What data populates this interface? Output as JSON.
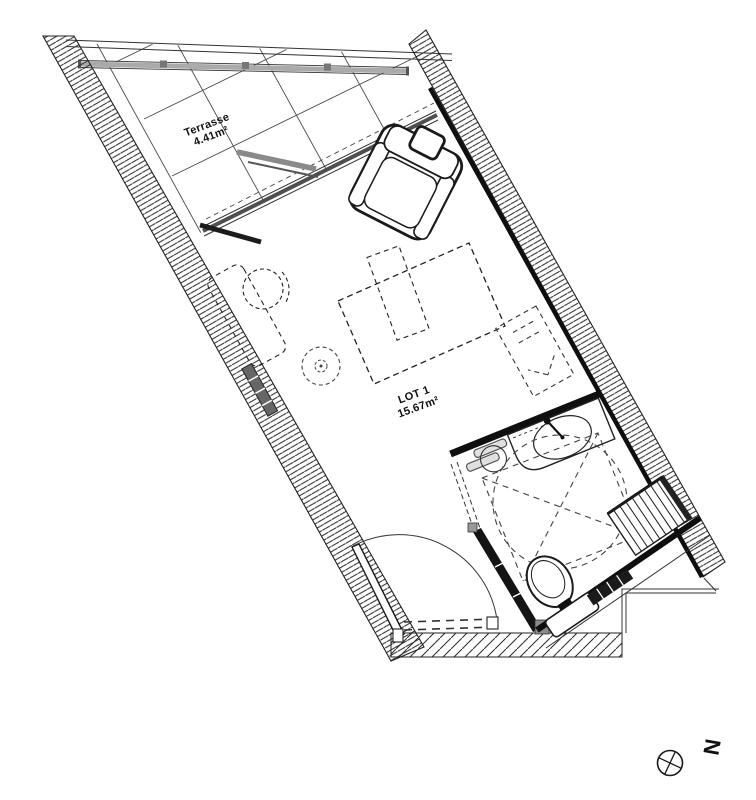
{
  "plan": {
    "terrace": {
      "label": "Terrasse",
      "area": "4.41m²"
    },
    "lot": {
      "label": "LOT 1",
      "area": "15.67m²"
    },
    "north": {
      "letter": "N"
    },
    "colors": {
      "line": "#1a1a1a",
      "wall_black": "#0f0f0f",
      "railing_gray": "#9a9a9a",
      "glass_gray": "#4f4f4f",
      "background": "#ffffff"
    }
  }
}
